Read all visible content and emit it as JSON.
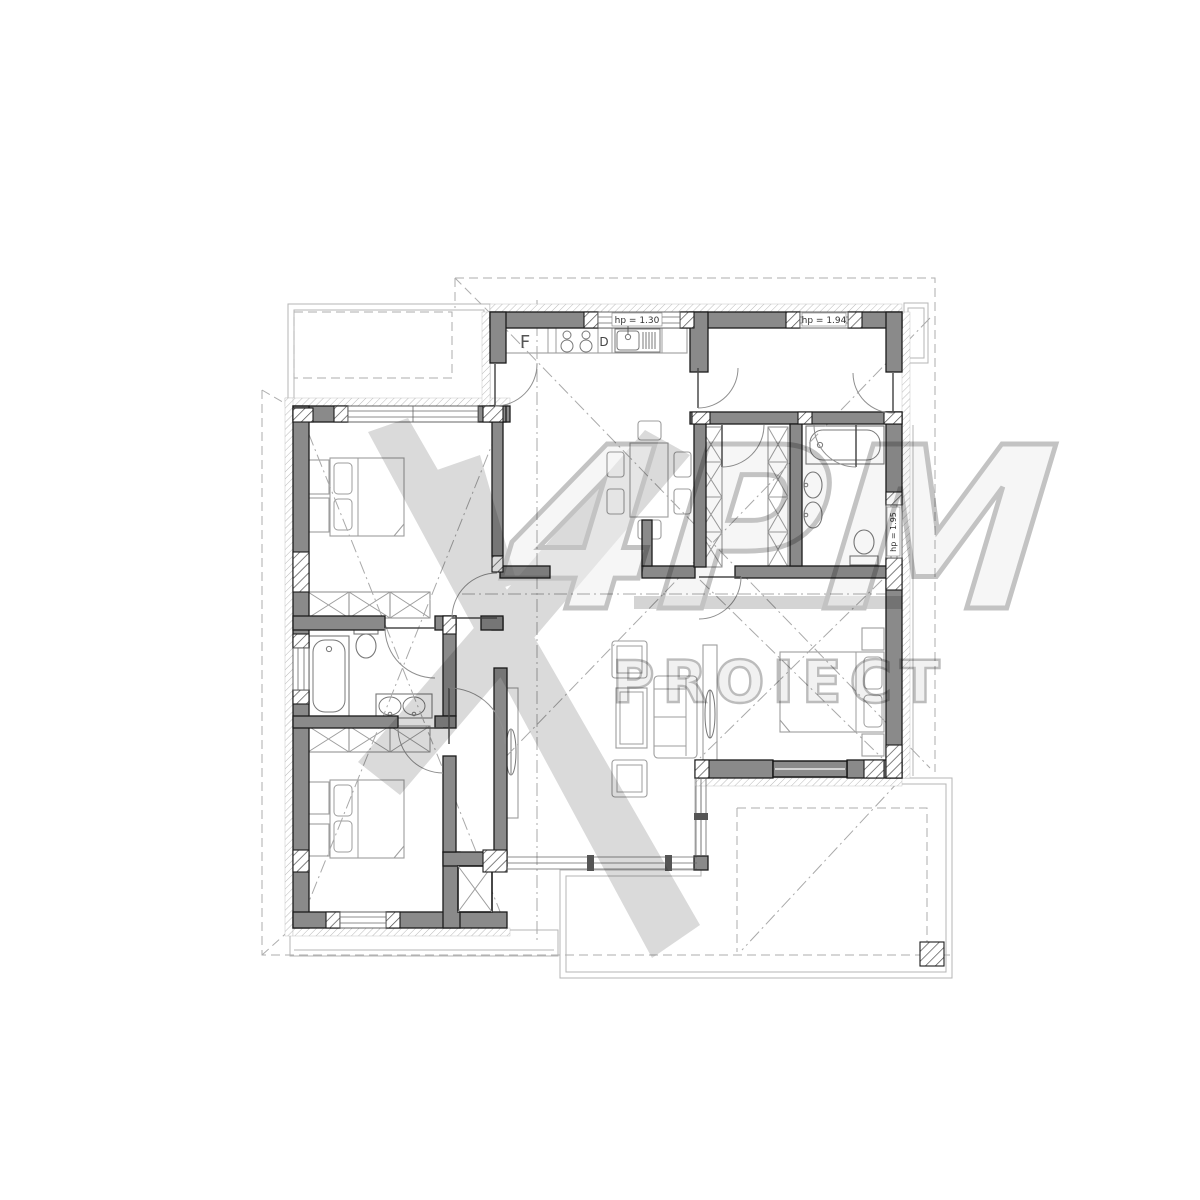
{
  "drawing": {
    "type": "architectural floor plan",
    "labels": {
      "fridge": "F",
      "dishwasher": "D",
      "kitchen_window_parapet": "hp = 1.30",
      "hall_window_parapet": "hp = 1.94",
      "bath_window_parapet": "hp = 1.95"
    },
    "watermark": {
      "logo": "4PM",
      "word": "PROIECT"
    },
    "colors": {
      "background": "#ffffff",
      "wall_fill": "#8a8a8a",
      "wall_outline": "#1b1b1b",
      "fixture_line": "#787878",
      "furniture_line": "#9d9d9d",
      "dashed_line": "#a9a9a9",
      "watermark_gray": "#c6c6c6"
    }
  }
}
